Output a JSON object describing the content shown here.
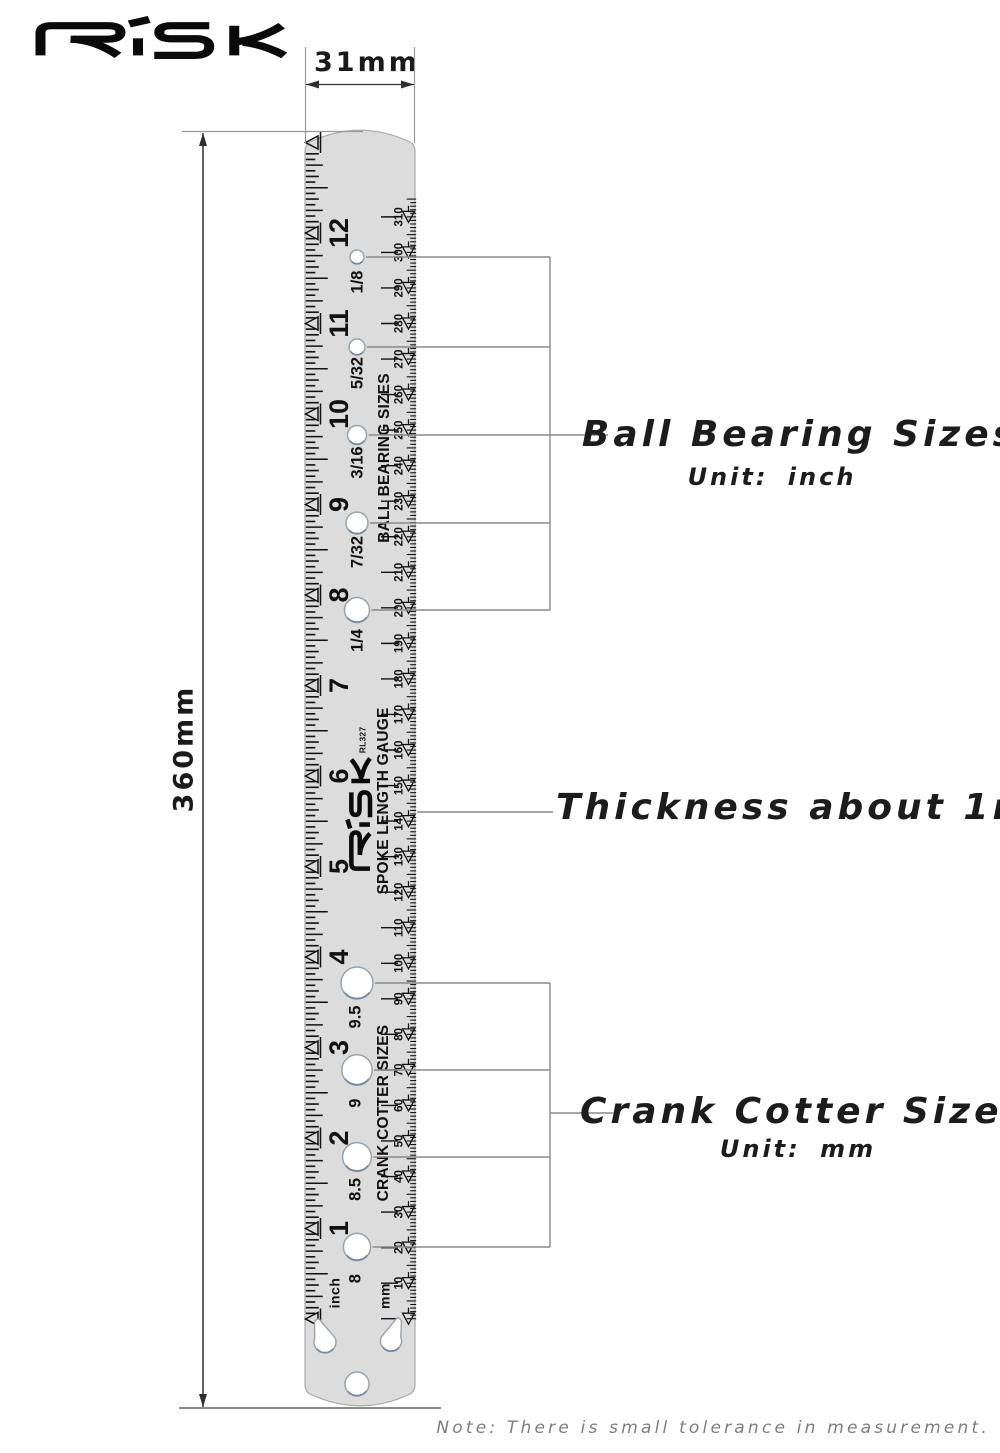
{
  "logo_text": "RISK",
  "dimensions": {
    "width_label": "31mm",
    "height_label": "360mm"
  },
  "ruler": {
    "brand": "RISK",
    "model": "RL327",
    "gauge_title": "SPOKE LENGTH GAUGE",
    "inch_unit_label": "inch",
    "mm_unit_label": "mm",
    "inch_numbers": [
      "12",
      "11",
      "10",
      "9",
      "8",
      "7",
      "6",
      "5",
      "4",
      "3",
      "2",
      "1"
    ],
    "mm_numbers": [
      "310",
      "300",
      "290",
      "280",
      "270",
      "260",
      "250",
      "240",
      "230",
      "220",
      "210",
      "200",
      "190",
      "180",
      "170",
      "160",
      "150",
      "140",
      "130",
      "120",
      "110",
      "100",
      "90",
      "80",
      "70",
      "60",
      "50",
      "40",
      "30",
      "20",
      "10"
    ],
    "ball_bearing": {
      "title": "BALL BEARING SIZES",
      "hole_labels": [
        "1/8",
        "5/32",
        "3/16",
        "7/32",
        "1/4"
      ]
    },
    "crank_cotter": {
      "title": "CRANK COTTER SIZES",
      "hole_labels": [
        "9.5",
        "9",
        "8.5",
        "8"
      ]
    }
  },
  "annotations": {
    "ball_bearing": {
      "title": "Ball Bearing Sizes",
      "unit": "Unit:  inch"
    },
    "thickness": "Thickness about 1mm",
    "crank_cotter": {
      "title": "Crank Cotter Sizes",
      "unit": "Unit:  mm"
    },
    "note": "Note: There is small tolerance in measurement."
  },
  "colors": {
    "ruler_fill": "#dcdcdc",
    "ruler_stroke": "#ababab",
    "tick": "#111111",
    "bracket_line": "#8a8a8a",
    "extension_line": "#9a9a9a",
    "dimension_line": "#2e2e2e",
    "hole_stroke": "#97a3ad",
    "hole_shadow": "#6f87a0",
    "note_text": "#7e7e7e"
  }
}
